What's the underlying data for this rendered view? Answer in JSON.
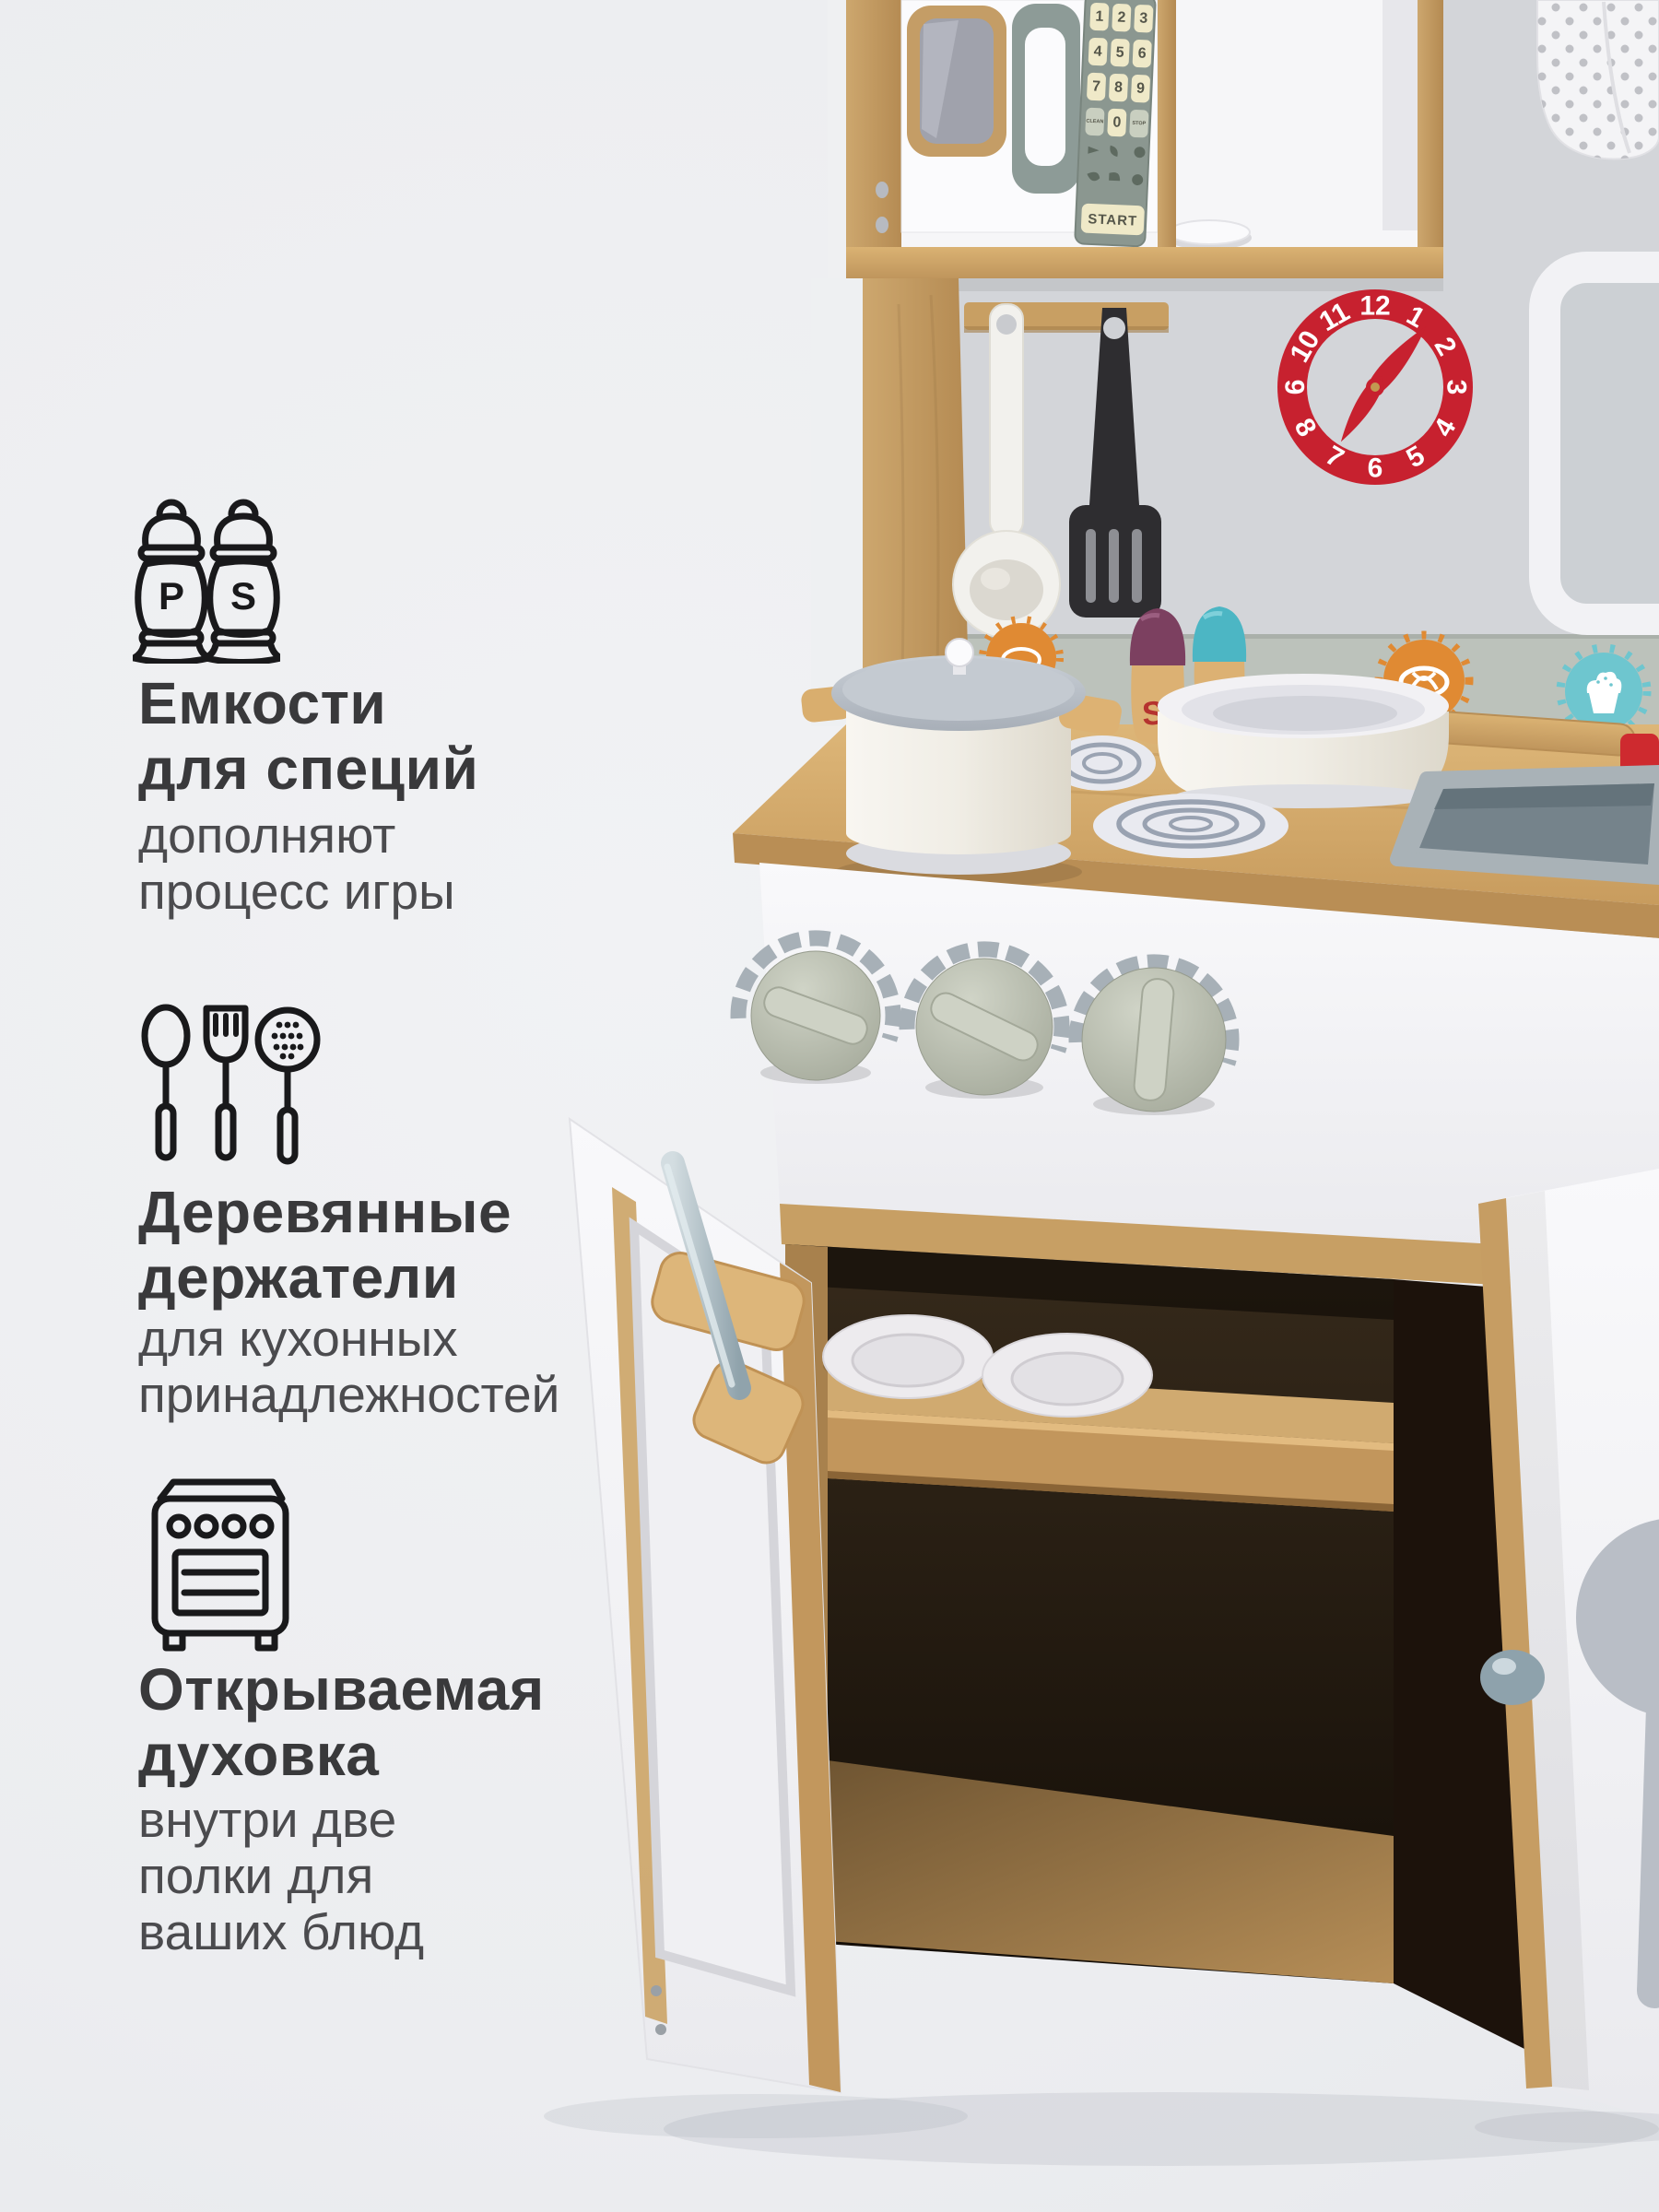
{
  "features": [
    {
      "icon": "pepper-salt-grinders-icon",
      "title_lines": [
        "Емкости",
        "для специй"
      ],
      "body_lines": [
        "дополняют",
        "процесс игры"
      ]
    },
    {
      "icon": "kitchen-utensils-icon",
      "title_lines": [
        "Деревянные",
        "держатели"
      ],
      "body_lines": [
        "для кухонных",
        "принадлежностей"
      ]
    },
    {
      "icon": "oven-icon",
      "title_lines": [
        "Открываемая",
        "духовка"
      ],
      "body_lines": [
        "внутри две",
        "полки для",
        "ваших блюд"
      ]
    }
  ],
  "icons": {
    "grinder_letters": [
      "P",
      "S"
    ]
  },
  "photo": {
    "subject": "wooden toy play kitchen with microwave, clock, stove knobs and open oven",
    "microwave": {
      "keys": [
        "1",
        "2",
        "3",
        "4",
        "5",
        "6",
        "7",
        "8",
        "9",
        "CLEAN",
        "0",
        "STOP"
      ],
      "start_label": "START"
    },
    "clock": {
      "numbers": [
        "12",
        "1",
        "2",
        "3",
        "4",
        "5",
        "6",
        "7",
        "8",
        "9",
        "10",
        "11"
      ]
    },
    "shaker_letter": "S",
    "colors": {
      "wood": "#c9a066",
      "counter_wood": "#d2a868",
      "wall_gray": "#d3d5d9",
      "backsplash_sage": "#bcc2bb",
      "clock_red": "#c7212f",
      "orange_decal": "#e08a33",
      "teal_decal": "#6ec6cf",
      "purple_cap": "#7c4060",
      "teal_cap": "#4cb6c4",
      "red_cup": "#ce2a2f",
      "knob_gray": "#b6bab0"
    }
  }
}
